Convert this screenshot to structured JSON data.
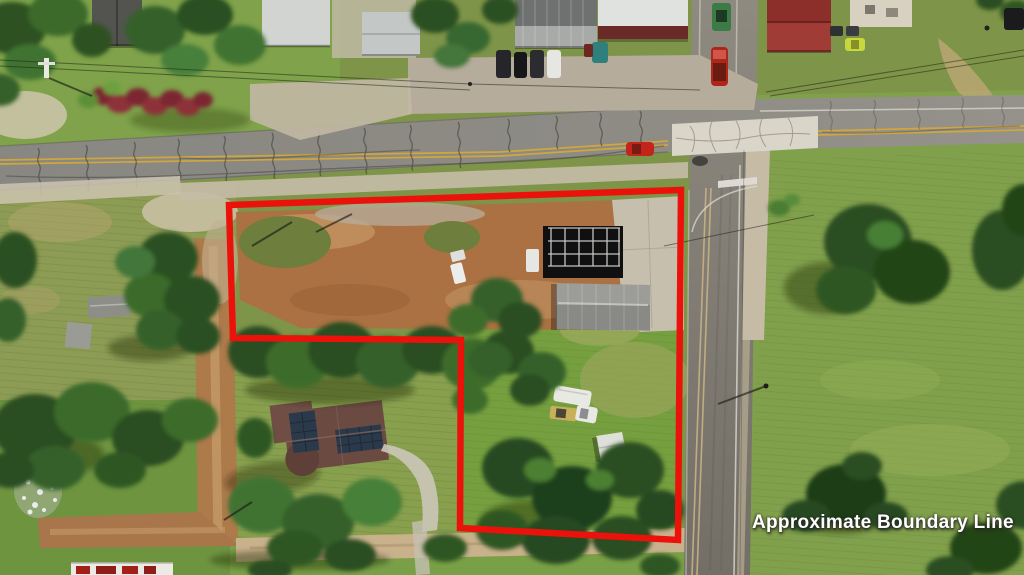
{
  "annotation": {
    "label": "Approximate Boundary Line",
    "boundary_points": "229,205 681,190 678,540 460,528 461,340 233,338",
    "boundary_color": "#ea120b",
    "boundary_stroke_width": "6.5",
    "label_color": "#ffffff"
  }
}
